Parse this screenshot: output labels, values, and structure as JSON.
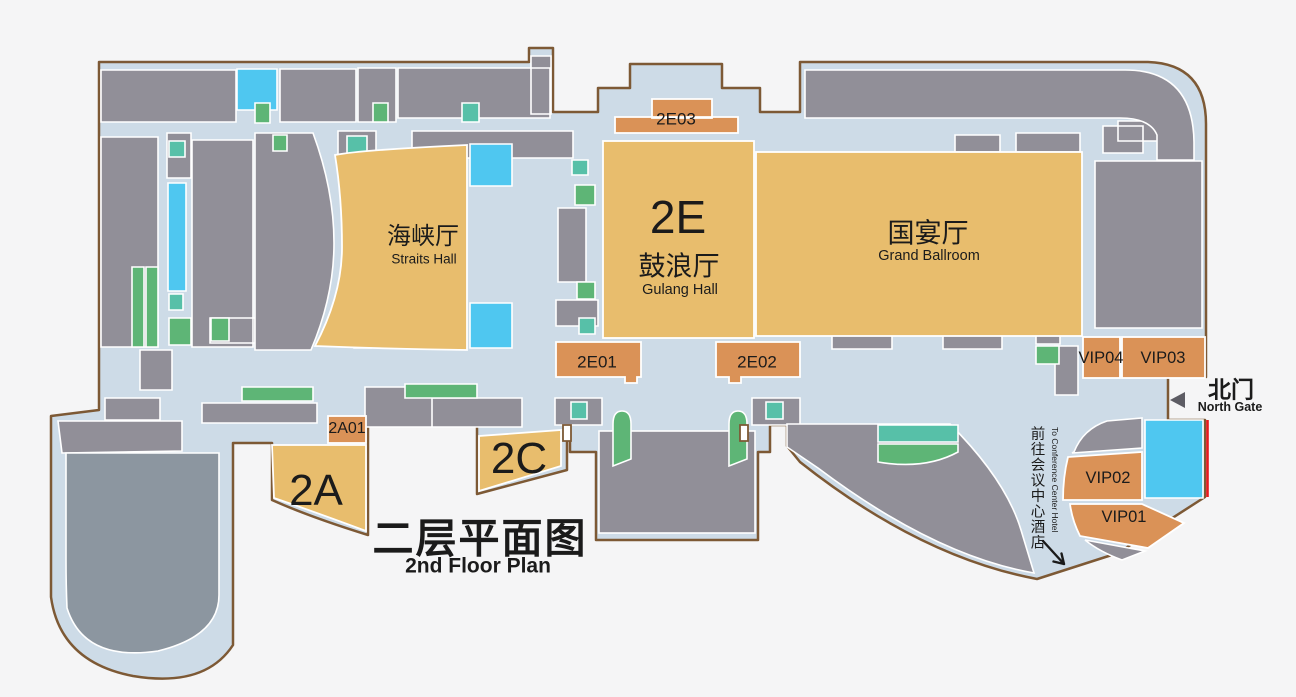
{
  "title": {
    "zh": "二层平面图",
    "en": "2nd Floor Plan"
  },
  "halls": {
    "straits": {
      "zh": "海峡厅",
      "en": "Straits Hall"
    },
    "gulang": {
      "code": "2E",
      "zh": "鼓浪厅",
      "en": "Gulang Hall"
    },
    "grand_ballroom": {
      "zh": "国宴厅",
      "en": "Grand Ballroom"
    }
  },
  "rooms": {
    "e01": "2E01",
    "e02": "2E02",
    "e03": "2E03",
    "a01": "2A01",
    "a": "2A",
    "c": "2C",
    "vip01": "VIP01",
    "vip02": "VIP02",
    "vip03": "VIP03",
    "vip04": "VIP04"
  },
  "north_gate": {
    "zh": "北门",
    "en": "North Gate"
  },
  "hotel_route": {
    "zh": "前往会议中心酒店",
    "en": "To Conference Center Hotel"
  },
  "colors": {
    "bg": "#f5f5f6",
    "floor": "#cddbe7",
    "wall": "#918f98",
    "theater": "#8c96a0",
    "hall": "#e8bd6d",
    "room": "#da9257",
    "green": "#5eb576",
    "teal": "#57c0a8",
    "cyan": "#4fc7f0",
    "border": "#7d5935",
    "red": "#e8191e",
    "text": "#1b1b1b",
    "gate": "#5d5c64"
  }
}
